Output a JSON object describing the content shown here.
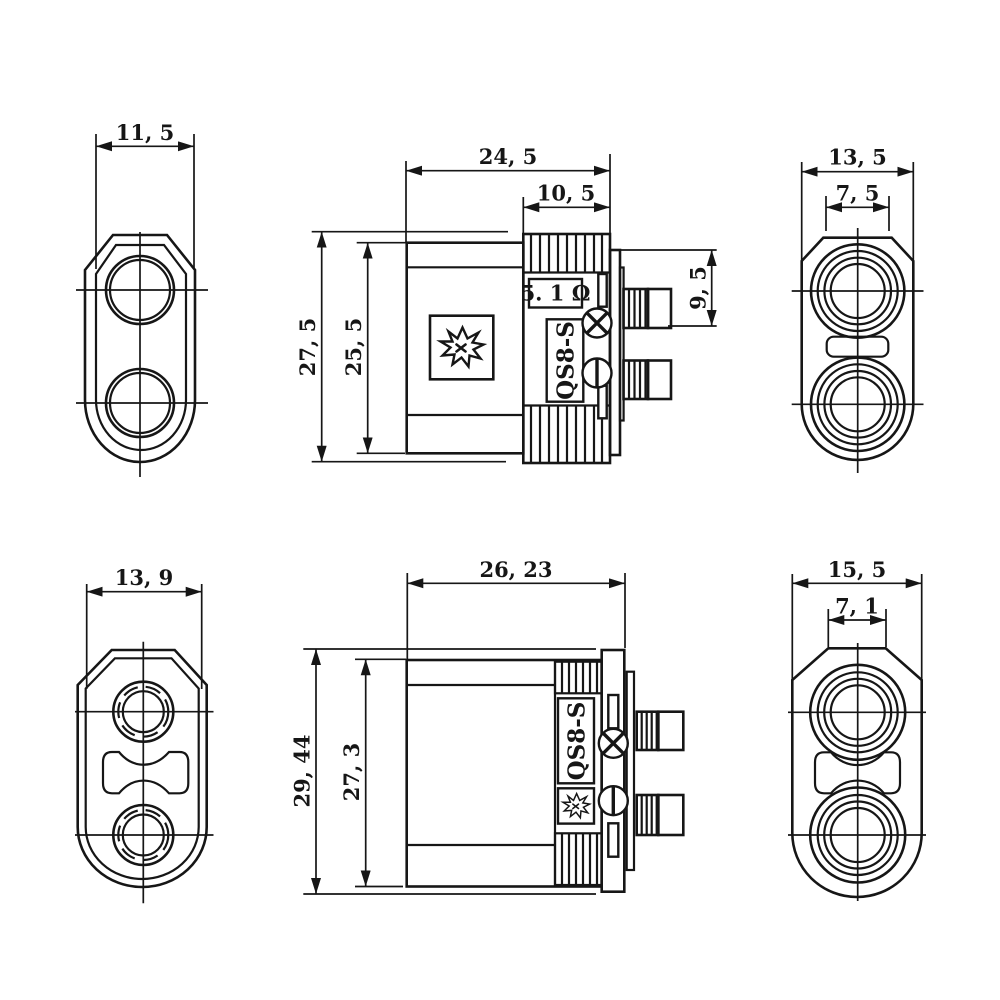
{
  "drawing": {
    "background": "#ffffff",
    "line_color": "#161616",
    "product": "QS8-S connector dimensional drawing",
    "views": {
      "top_left_front": {
        "width": "11, 5"
      },
      "top_middle_side": {
        "overall_width": "24, 5",
        "cap_width": "10, 5",
        "overall_height": "27, 5",
        "body_height": "25, 5",
        "bullet_spacing": "9, 5",
        "resistor_marking": "5. 1 Ω",
        "model_marking": "QS8-S"
      },
      "top_right_front": {
        "width": "13, 5",
        "hole_width": "7, 5"
      },
      "bottom_left_front": {
        "width": "13, 9"
      },
      "bottom_middle_side": {
        "overall_width": "26, 23",
        "overall_height": "29, 44",
        "body_height": "27, 3",
        "model_marking": "QS8-S"
      },
      "bottom_right_front": {
        "width": "15, 5",
        "hole_width": "7, 1"
      }
    }
  }
}
